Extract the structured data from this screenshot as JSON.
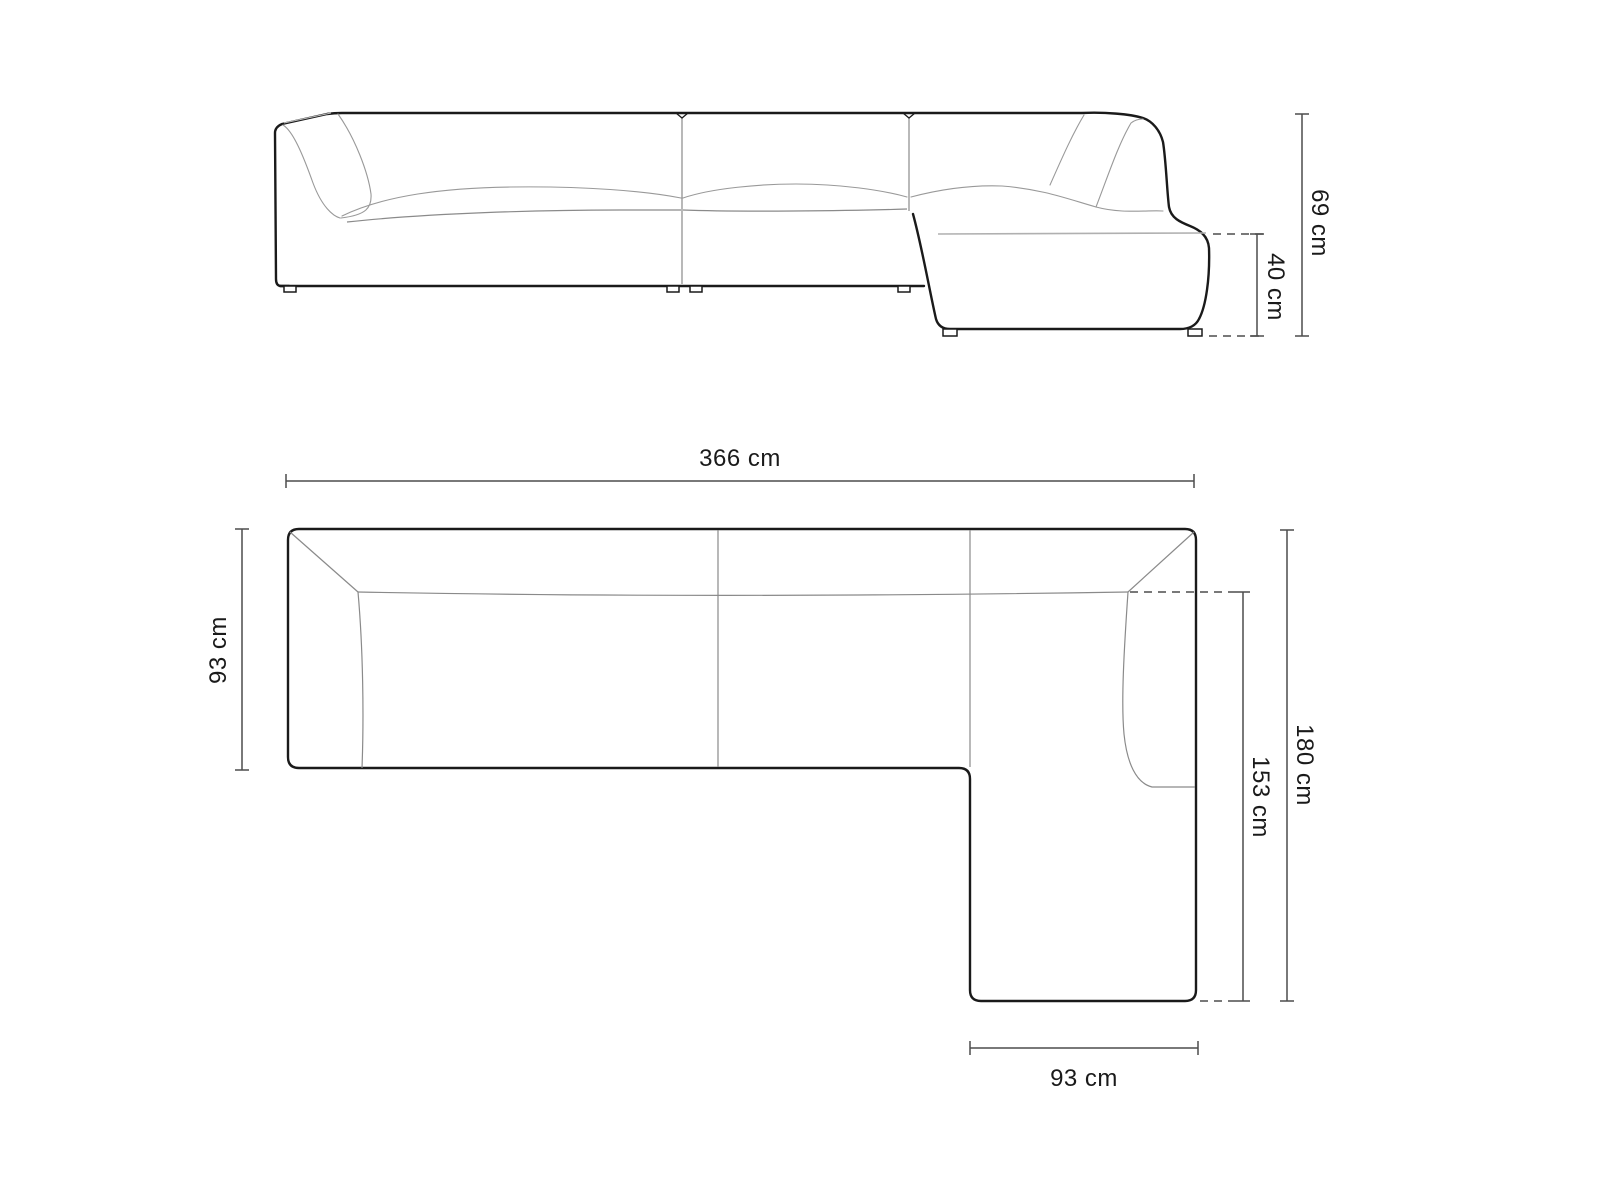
{
  "diagram": {
    "front_view": {
      "total_height": "69 cm",
      "seat_height": "40 cm"
    },
    "plan_view": {
      "total_width": "366 cm",
      "sofa_depth": "93 cm",
      "chaise_inner_length": "153 cm",
      "total_depth": "180 cm",
      "chaise_width": "93 cm"
    },
    "colors": {
      "outline": "#1a1a1a",
      "dimension_line": "#4d4d4d",
      "inner_line": "#999999",
      "label": "#1a1a1a",
      "background": "#ffffff"
    }
  }
}
